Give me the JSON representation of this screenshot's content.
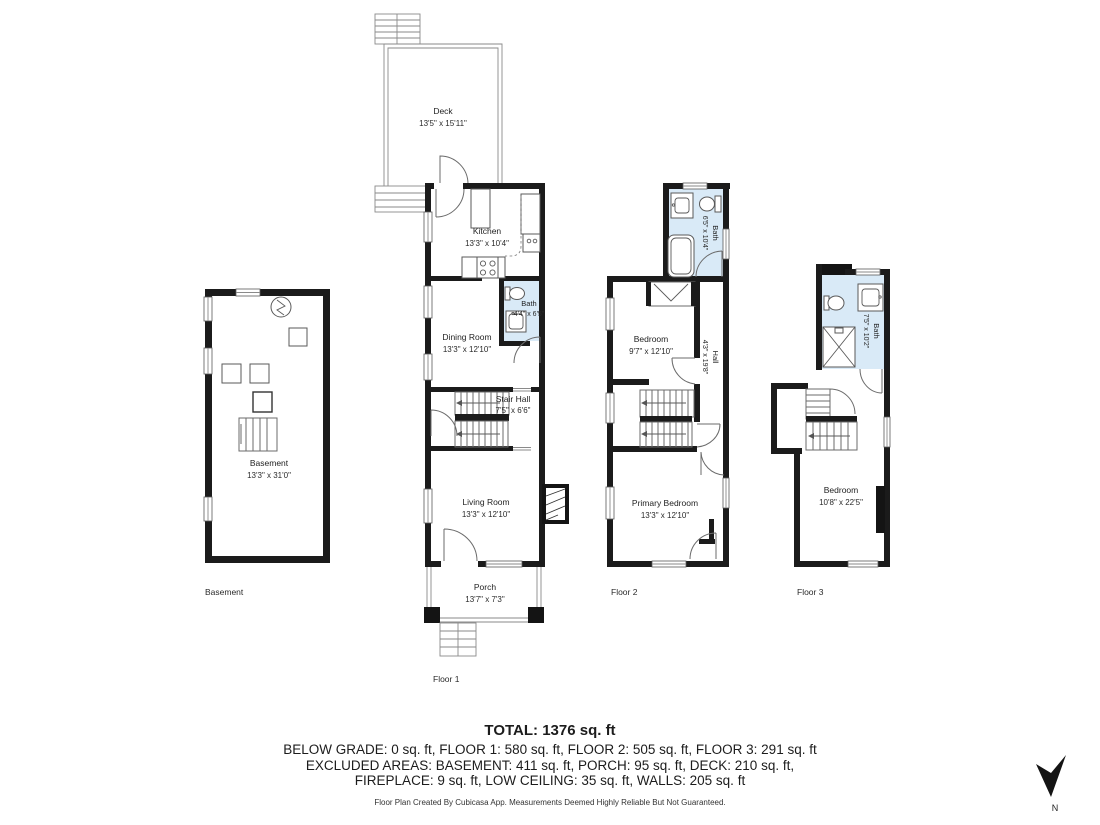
{
  "colors": {
    "wall": "#1b1b1b",
    "bath_fill": "#d9eaf7",
    "line": "#6b6b6b"
  },
  "plans": {
    "basement": {
      "floor_label": "Basement",
      "room": {
        "name": "Basement",
        "dims": "13'3\" x 31'0\""
      }
    },
    "floor1": {
      "floor_label": "Floor 1",
      "deck": {
        "name": "Deck",
        "dims": "13'5\" x 15'11\""
      },
      "kitchen": {
        "name": "Kitchen",
        "dims": "13'3\" x 10'4\""
      },
      "bath": {
        "name": "Bath",
        "dims": "4'4\" x 6'5\""
      },
      "dining": {
        "name": "Dining Room",
        "dims": "13'3\" x 12'10\""
      },
      "stair_hall": {
        "name": "Stair Hall",
        "dims": "7'5\" x 6'6\""
      },
      "living": {
        "name": "Living Room",
        "dims": "13'3\" x 12'10\""
      },
      "porch": {
        "name": "Porch",
        "dims": "13'7\" x 7'3\""
      }
    },
    "floor2": {
      "floor_label": "Floor 2",
      "bath": {
        "name": "Bath",
        "dims": "6'5\" x 10'4\""
      },
      "bedroom": {
        "name": "Bedroom",
        "dims": "9'7\" x 12'10\""
      },
      "hall": {
        "name": "Hall",
        "dims": "4'3\" x 19'8\""
      },
      "primary": {
        "name": "Primary Bedroom",
        "dims": "13'3\" x 12'10\""
      }
    },
    "floor3": {
      "floor_label": "Floor 3",
      "bath": {
        "name": "Bath",
        "dims": "7'5\" x 10'2\""
      },
      "bedroom": {
        "name": "Bedroom",
        "dims": "10'8\" x 22'5\""
      }
    }
  },
  "summary": {
    "total": "TOTAL: 1376 sq. ft",
    "line1": "BELOW GRADE: 0 sq. ft, FLOOR 1: 580 sq. ft, FLOOR 2: 505 sq. ft, FLOOR 3: 291 sq. ft",
    "line2": "EXCLUDED AREAS: BASEMENT: 411 sq. ft, PORCH: 95 sq. ft, DECK: 210 sq. ft,",
    "line3": "FIREPLACE: 9 sq. ft, LOW CEILING: 35 sq. ft, WALLS: 205 sq. ft",
    "disclaimer": "Floor Plan Created By Cubicasa App. Measurements Deemed Highly Reliable But Not Guaranteed."
  },
  "compass": {
    "label": "N"
  }
}
